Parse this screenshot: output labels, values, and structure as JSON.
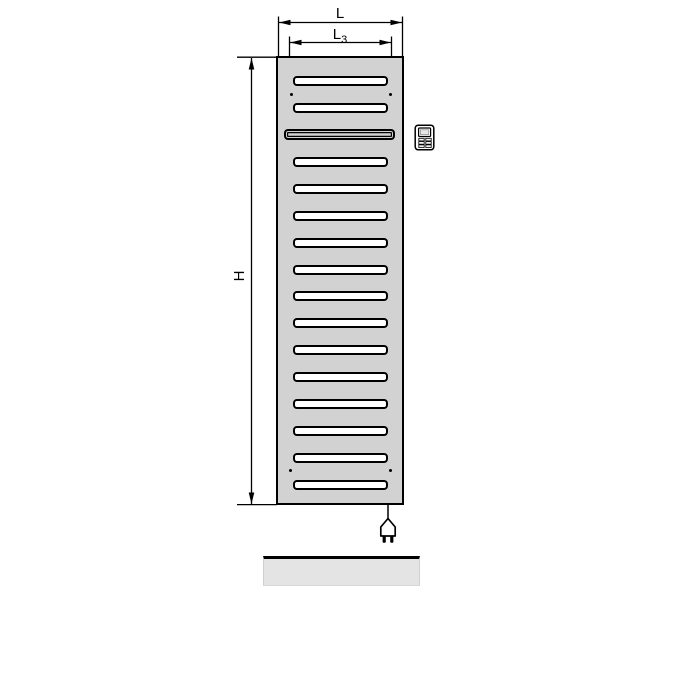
{
  "diagram": {
    "type": "technical-drawing",
    "subject": "electric panel radiator, front view with dimensions"
  },
  "labels": {
    "width": "L",
    "inner_width_base": "L",
    "inner_width_sub": "3",
    "height": "H"
  },
  "radiator": {
    "slot_count": 16,
    "special_slot_index": 2,
    "mounting_dot_count": 4
  },
  "icons": {
    "control_unit": "control-unit-icon",
    "power_plug": "power-plug-icon"
  },
  "colors": {
    "background": "#ffffff",
    "radiator_body": "#d2d2d2",
    "radiator_outline": "#000000",
    "slot_fill": "#ffffff",
    "line": "#000000",
    "floor_bar": "#e4e4e4"
  }
}
